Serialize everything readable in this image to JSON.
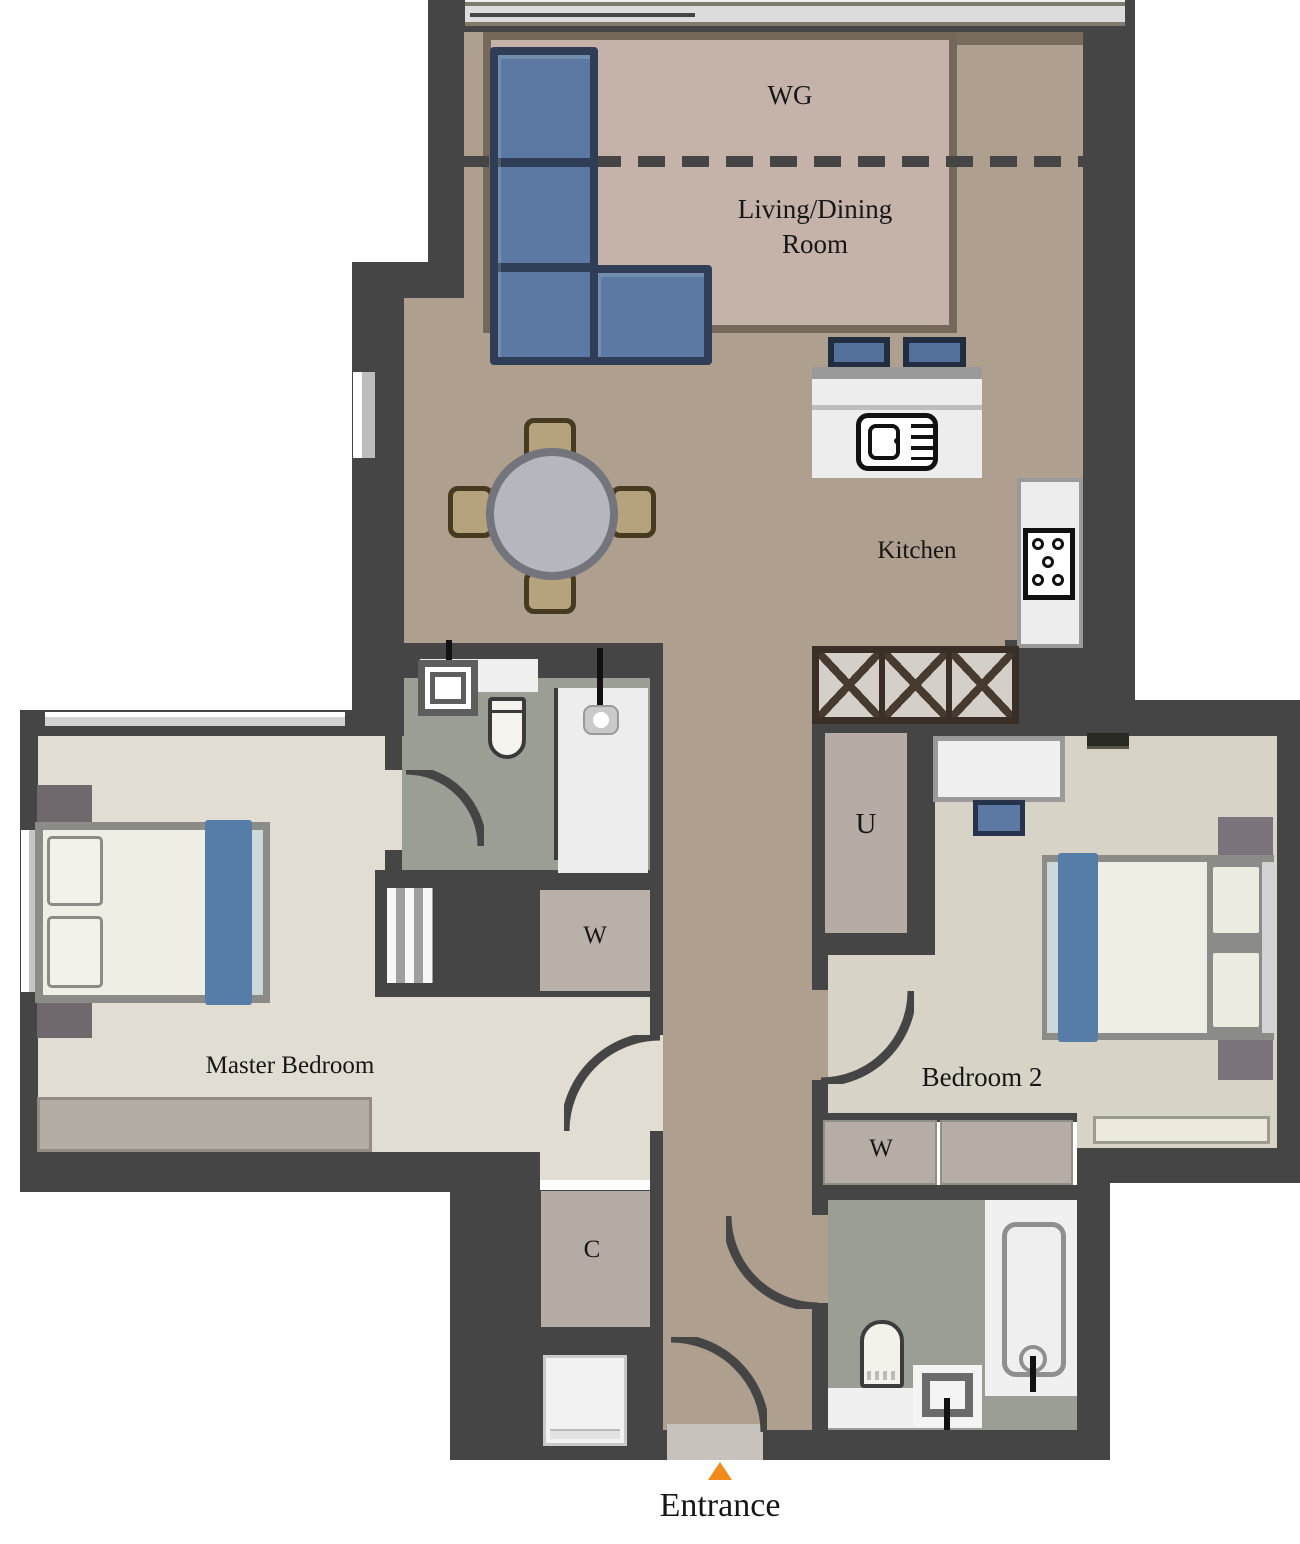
{
  "plan": {
    "title": "Apartment Floor Plan",
    "labels": {
      "wg": "WG",
      "living_line1": "Living/Dining",
      "living_line2": "Room",
      "kitchen": "Kitchen",
      "master_bedroom": "Master Bedroom",
      "bedroom2": "Bedroom 2",
      "utility": "U",
      "wardrobe_master": "W",
      "wardrobe_bedroom2": "W",
      "closet": "C",
      "entrance": "Entrance"
    },
    "colors": {
      "wall": "#454545",
      "floor_living": "#ae9f8f",
      "rug": "#c5b3aa",
      "rug_border": "#76675b",
      "floor_master": "#e1ddd2",
      "floor_bedroom2": "#d7d3c6",
      "floor_bathroom": "#9b9e95",
      "sofa_blue": "#5b79a2",
      "sofa_border": "#2f3e56",
      "bed_accent_blue": "#567da8",
      "closet_taupe": "#b5ada5",
      "table_gray": "#b6b6be",
      "chair_tan": "#b4a37d",
      "entrance_marker_orange": "#f28a1c"
    },
    "furniture": [
      "corner-sofa",
      "bar-stools",
      "kitchen-sink",
      "stove-hob",
      "base-cabinets",
      "dining-table",
      "dining-chairs",
      "master-bed",
      "nightstands",
      "dresser",
      "shelf-closet",
      "ensuite-sink",
      "ensuite-toilet",
      "shower",
      "wardrobe",
      "bed-2",
      "desk",
      "desk-chair",
      "bench",
      "bathtub",
      "toilet",
      "bathroom-sink",
      "washing-machine",
      "entrance-mat",
      "door-swings"
    ]
  }
}
